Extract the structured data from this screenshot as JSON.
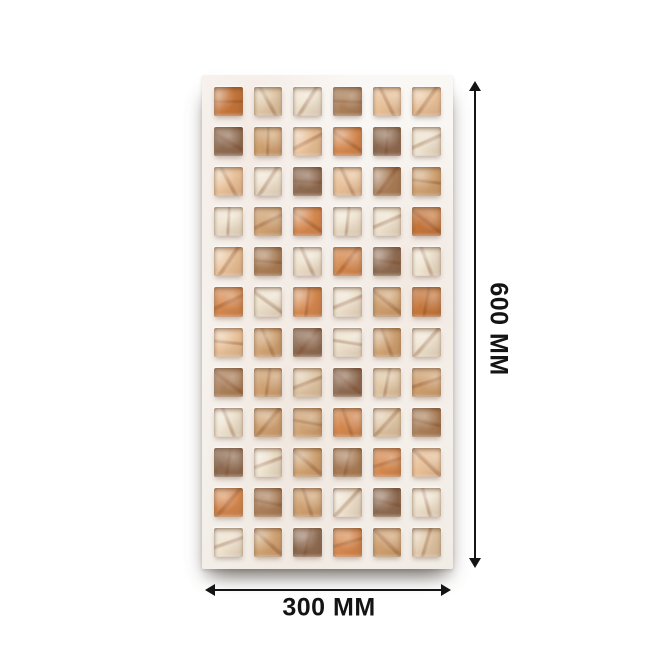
{
  "dimensions": {
    "height_label": "600 MM",
    "width_label": "300 MM",
    "arrow_color": "#141414"
  },
  "tile": {
    "rows": 12,
    "cols": 6,
    "base_color": "#f7f4f0",
    "vein_color": "#cd9678",
    "palette": {
      "C": "#eee3cf",
      "B": "#dfc7a6",
      "P": "#e9c29a",
      "T": "#cfa272",
      "O": "#d5884e",
      "R": "#c5763b",
      "N": "#a97e58",
      "D": "#8d6b52"
    },
    "cells": [
      "RBCNPP",
      "DTPODC",
      "PCDPNT",
      "CTOCCR",
      "PNCODC",
      "OCOCTR",
      "PTDCTC",
      "NTBDBT",
      "CTTOBN",
      "DCTNOP",
      "ONTCDC",
      "CTDOTB"
    ]
  }
}
